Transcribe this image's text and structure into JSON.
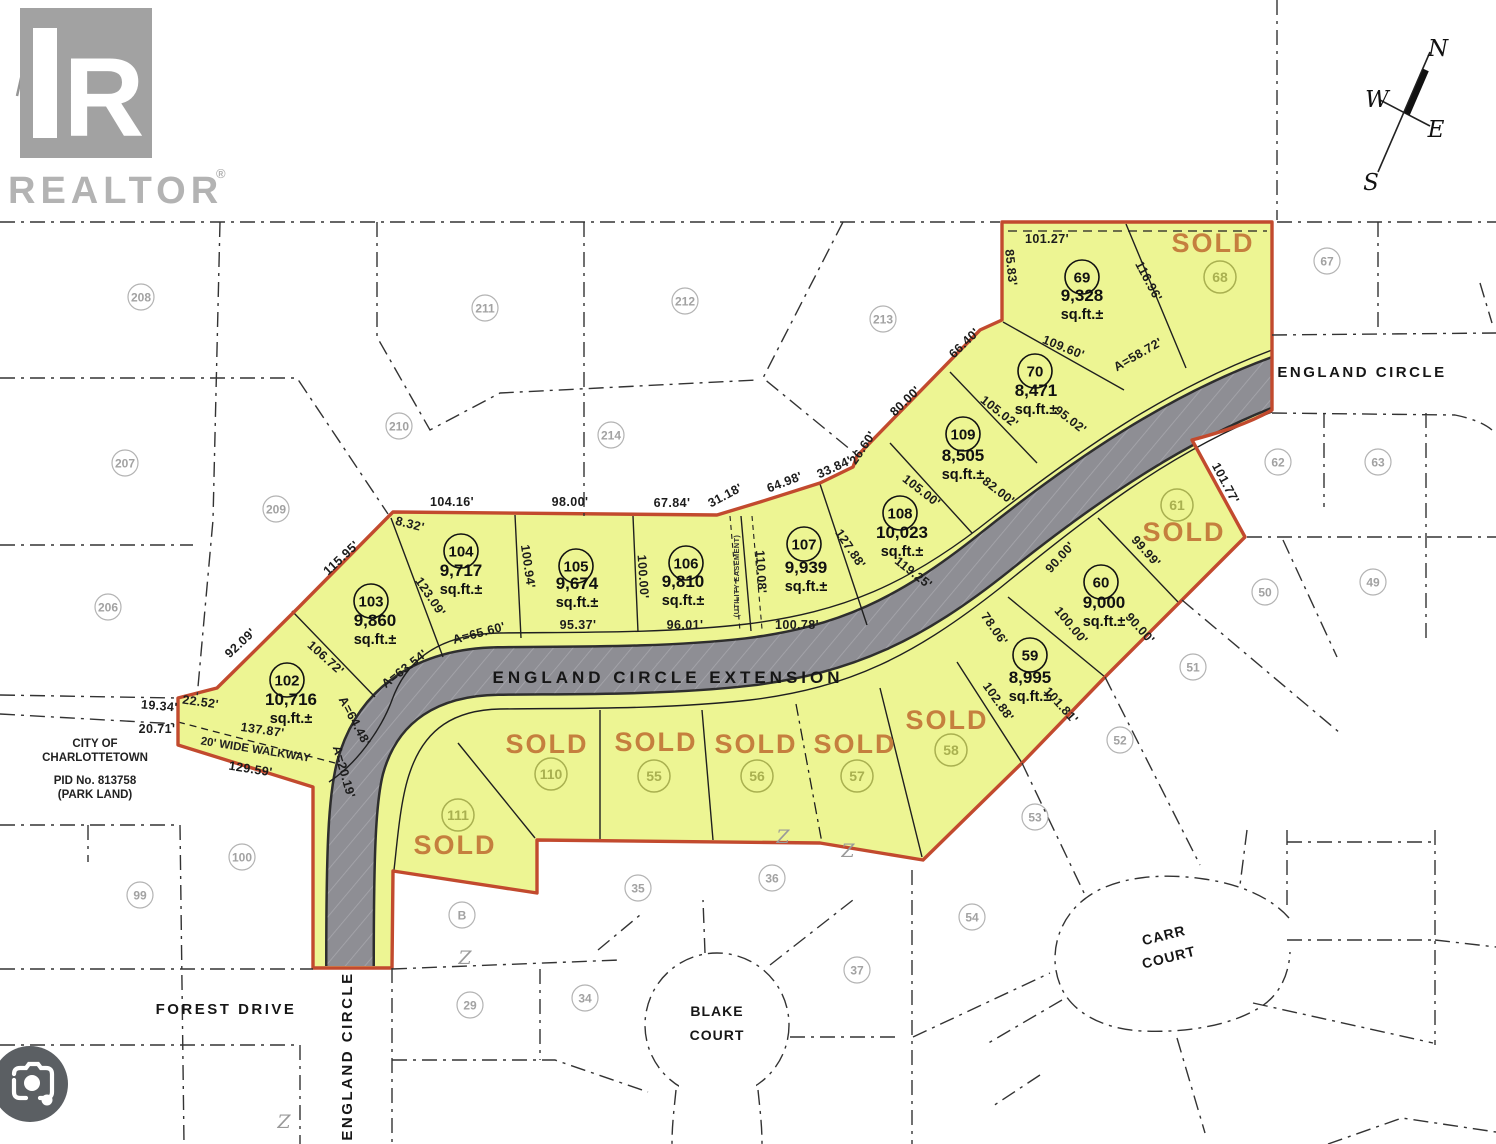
{
  "branding": {
    "logo_letter": "R",
    "logo_word": "REALTOR",
    "registered": "®"
  },
  "compass": {
    "north": "N",
    "west": "W",
    "east": "E",
    "south": "S"
  },
  "park_note": {
    "x": 95,
    "lines": [
      {
        "t": "CITY OF",
        "y": 747
      },
      {
        "t": "CHARLOTTETOWN",
        "y": 761
      },
      {
        "t": "PID No. 813758",
        "y": 784
      },
      {
        "t": "(PARK LAND)",
        "y": 798
      }
    ]
  },
  "labels": {
    "sold": "SOLD",
    "area_suffix": "sq.ft.±",
    "walkway": {
      "t": "20' WIDE WALKWAY",
      "x": 255,
      "y": 753,
      "r": 9
    },
    "easement": {
      "t": "(UTILITY EASEMENT)",
      "x": 739,
      "y": 576,
      "r": -90
    }
  },
  "roads": [
    {
      "id": "england-circle-extension",
      "label": "ENGLAND CIRCLE EXTENSION",
      "x": 668,
      "y": 683,
      "size": 17,
      "spacing": 4,
      "rot": 0
    },
    {
      "id": "england-circle-east",
      "label": "ENGLAND CIRCLE",
      "x": 1362,
      "y": 377,
      "size": 15,
      "spacing": 2.5,
      "rot": 0
    },
    {
      "id": "england-circle-south",
      "label": "ENGLAND CIRCLE",
      "x": 352,
      "y": 1056,
      "size": 15,
      "spacing": 2.5,
      "rot": -90
    },
    {
      "id": "forest-drive",
      "label": "FOREST DRIVE",
      "x": 226,
      "y": 1014,
      "size": 15,
      "spacing": 2.5,
      "rot": 0
    },
    {
      "id": "blake-court-line1",
      "label": "BLAKE",
      "x": 717,
      "y": 1016,
      "size": 14,
      "spacing": 1,
      "rot": 0
    },
    {
      "id": "blake-court-line2",
      "label": "COURT",
      "x": 717,
      "y": 1040,
      "size": 14,
      "spacing": 1,
      "rot": 0
    },
    {
      "id": "carr-court-line1",
      "label": "CARR",
      "x": 1165,
      "y": 940,
      "size": 14,
      "spacing": 1,
      "rot": -14
    },
    {
      "id": "carr-court-line2",
      "label": "COURT",
      "x": 1170,
      "y": 962,
      "size": 14,
      "spacing": 1,
      "rot": -14
    }
  ],
  "lots_available": [
    {
      "num": "102",
      "area": "10,716",
      "cx": 287,
      "cy": 680,
      "ax": 291,
      "ay": 705
    },
    {
      "num": "103",
      "area": "9,860",
      "cx": 371,
      "cy": 601,
      "ax": 375,
      "ay": 626
    },
    {
      "num": "104",
      "area": "9,717",
      "cx": 461,
      "cy": 551,
      "ax": 461,
      "ay": 576
    },
    {
      "num": "105",
      "area": "9,674",
      "cx": 576,
      "cy": 566,
      "ax": 577,
      "ay": 589
    },
    {
      "num": "106",
      "area": "9,810",
      "cx": 686,
      "cy": 563,
      "ax": 683,
      "ay": 587
    },
    {
      "num": "107",
      "area": "9,939",
      "cx": 804,
      "cy": 544,
      "ax": 806,
      "ay": 573
    },
    {
      "num": "108",
      "area": "10,023",
      "cx": 900,
      "cy": 513,
      "ax": 902,
      "ay": 538
    },
    {
      "num": "109",
      "area": "8,505",
      "cx": 963,
      "cy": 434,
      "ax": 963,
      "ay": 461
    },
    {
      "num": "70",
      "area": "8,471",
      "cx": 1035,
      "cy": 371,
      "ax": 1036,
      "ay": 396
    },
    {
      "num": "69",
      "area": "9,328",
      "cx": 1082,
      "cy": 277,
      "ax": 1082,
      "ay": 301
    },
    {
      "num": "59",
      "area": "8,995",
      "cx": 1030,
      "cy": 655,
      "ax": 1030,
      "ay": 683
    },
    {
      "num": "60",
      "area": "9,000",
      "cx": 1101,
      "cy": 582,
      "ax": 1104,
      "ay": 608
    }
  ],
  "lots_sold": [
    {
      "num": "68",
      "cx": 1220,
      "cy": 277,
      "sx": 1213,
      "sy": 252,
      "size": 29
    },
    {
      "num": "61",
      "cx": 1177,
      "cy": 505,
      "sx": 1184,
      "sy": 541,
      "size": 29
    },
    {
      "num": "58",
      "cx": 951,
      "cy": 750,
      "sx": 947,
      "sy": 729,
      "size": 27
    },
    {
      "num": "57",
      "cx": 857,
      "cy": 776,
      "sx": 855,
      "sy": 753,
      "size": 27
    },
    {
      "num": "56",
      "cx": 757,
      "cy": 776,
      "sx": 756,
      "sy": 753,
      "size": 27
    },
    {
      "num": "55",
      "cx": 654,
      "cy": 776,
      "sx": 656,
      "sy": 751,
      "size": 27
    },
    {
      "num": "110",
      "cx": 551,
      "cy": 774,
      "sx": 547,
      "sy": 753,
      "size": 27
    },
    {
      "num": "111",
      "cx": 458,
      "cy": 815,
      "sx": 455,
      "sy": 854,
      "size": 27
    }
  ],
  "lots_adjacent": [
    {
      "num": "208",
      "cx": 141,
      "cy": 297
    },
    {
      "num": "211",
      "cx": 485,
      "cy": 308
    },
    {
      "num": "212",
      "cx": 685,
      "cy": 301
    },
    {
      "num": "213",
      "cx": 883,
      "cy": 319
    },
    {
      "num": "67",
      "cx": 1327,
      "cy": 261
    },
    {
      "num": "210",
      "cx": 399,
      "cy": 426
    },
    {
      "num": "214",
      "cx": 611,
      "cy": 435
    },
    {
      "num": "207",
      "cx": 125,
      "cy": 463
    },
    {
      "num": "209",
      "cx": 276,
      "cy": 509
    },
    {
      "num": "206",
      "cx": 108,
      "cy": 607
    },
    {
      "num": "62",
      "cx": 1278,
      "cy": 462
    },
    {
      "num": "63",
      "cx": 1378,
      "cy": 462
    },
    {
      "num": "49",
      "cx": 1373,
      "cy": 582
    },
    {
      "num": "50",
      "cx": 1265,
      "cy": 592
    },
    {
      "num": "51",
      "cx": 1193,
      "cy": 667
    },
    {
      "num": "52",
      "cx": 1120,
      "cy": 740
    },
    {
      "num": "53",
      "cx": 1035,
      "cy": 817
    },
    {
      "num": "54",
      "cx": 972,
      "cy": 917
    },
    {
      "num": "100",
      "cx": 242,
      "cy": 857
    },
    {
      "num": "99",
      "cx": 140,
      "cy": 895
    },
    {
      "num": "B",
      "cx": 462,
      "cy": 915
    },
    {
      "num": "29",
      "cx": 470,
      "cy": 1005
    },
    {
      "num": "34",
      "cx": 585,
      "cy": 998
    },
    {
      "num": "35",
      "cx": 638,
      "cy": 888
    },
    {
      "num": "36",
      "cx": 772,
      "cy": 878
    },
    {
      "num": "37",
      "cx": 857,
      "cy": 970
    }
  ],
  "dimensions": [
    {
      "t": "101.27'",
      "x": 1047,
      "y": 243,
      "r": 0
    },
    {
      "t": "85.83'",
      "x": 1007,
      "y": 268,
      "r": 84
    },
    {
      "t": "116.96'",
      "x": 1145,
      "y": 283,
      "r": 62
    },
    {
      "t": "109.60'",
      "x": 1062,
      "y": 351,
      "r": 22
    },
    {
      "t": "A=58.72'",
      "x": 1140,
      "y": 358,
      "r": -30
    },
    {
      "t": "66.40'",
      "x": 967,
      "y": 346,
      "r": -44
    },
    {
      "t": "80.00'",
      "x": 908,
      "y": 404,
      "r": -44
    },
    {
      "t": "105.02'",
      "x": 997,
      "y": 415,
      "r": 38
    },
    {
      "t": "95.02'",
      "x": 1068,
      "y": 423,
      "r": 38
    },
    {
      "t": "105.00'",
      "x": 919,
      "y": 494,
      "r": 38
    },
    {
      "t": "82.00'",
      "x": 996,
      "y": 494,
      "r": 38
    },
    {
      "t": "119.25'",
      "x": 911,
      "y": 576,
      "r": 38
    },
    {
      "t": "26.60'",
      "x": 866,
      "y": 450,
      "r": -56
    },
    {
      "t": "33.84'",
      "x": 836,
      "y": 471,
      "r": -24
    },
    {
      "t": "64.98'",
      "x": 786,
      "y": 486,
      "r": -21
    },
    {
      "t": "31.18'",
      "x": 727,
      "y": 499,
      "r": -28
    },
    {
      "t": "67.84'",
      "x": 672,
      "y": 507,
      "r": 0
    },
    {
      "t": "98.00'",
      "x": 570,
      "y": 506,
      "r": 0
    },
    {
      "t": "104.16'",
      "x": 452,
      "y": 506,
      "r": 0
    },
    {
      "t": "8.32'",
      "x": 409,
      "y": 528,
      "r": 14
    },
    {
      "t": "115.95'",
      "x": 344,
      "y": 561,
      "r": -43
    },
    {
      "t": "92.09'",
      "x": 243,
      "y": 646,
      "r": -43
    },
    {
      "t": "123.09'",
      "x": 427,
      "y": 599,
      "r": 56
    },
    {
      "t": "100.94'",
      "x": 524,
      "y": 567,
      "r": 82
    },
    {
      "t": "100.00'",
      "x": 639,
      "y": 577,
      "r": 86
    },
    {
      "t": "110.08'",
      "x": 757,
      "y": 572,
      "r": 87
    },
    {
      "t": "127.88'",
      "x": 847,
      "y": 551,
      "r": 56
    },
    {
      "t": "95.37'",
      "x": 578,
      "y": 629,
      "r": 0
    },
    {
      "t": "96.01'",
      "x": 685,
      "y": 629,
      "r": 0
    },
    {
      "t": "100.78'",
      "x": 797,
      "y": 629,
      "r": 0
    },
    {
      "t": "A=65.60'",
      "x": 480,
      "y": 637,
      "r": -15
    },
    {
      "t": "A=63.54'",
      "x": 407,
      "y": 672,
      "r": -38
    },
    {
      "t": "106.72'",
      "x": 323,
      "y": 661,
      "r": 42
    },
    {
      "t": "A=64.48'",
      "x": 351,
      "y": 723,
      "r": 62
    },
    {
      "t": "A=20.19'",
      "x": 340,
      "y": 773,
      "r": 74
    },
    {
      "t": "22.52'",
      "x": 200,
      "y": 706,
      "r": 8
    },
    {
      "t": "19.34'",
      "x": 159,
      "y": 710,
      "r": 5
    },
    {
      "t": "20.71'",
      "x": 157,
      "y": 733,
      "r": 0
    },
    {
      "t": "137.87'",
      "x": 262,
      "y": 734,
      "r": 8
    },
    {
      "t": "129.59'",
      "x": 250,
      "y": 773,
      "r": 9
    },
    {
      "t": "78.06'",
      "x": 991,
      "y": 631,
      "r": 55
    },
    {
      "t": "102.88'",
      "x": 995,
      "y": 704,
      "r": 55
    },
    {
      "t": "100.00'",
      "x": 1068,
      "y": 628,
      "r": 50
    },
    {
      "t": "101.81'",
      "x": 1058,
      "y": 708,
      "r": 48
    },
    {
      "t": "90.00'",
      "x": 1063,
      "y": 560,
      "r": -48
    },
    {
      "t": "99.99'",
      "x": 1143,
      "y": 554,
      "r": 48
    },
    {
      "t": "90.00'",
      "x": 1137,
      "y": 631,
      "r": 48
    },
    {
      "t": "101.77'",
      "x": 1222,
      "y": 485,
      "r": 62
    }
  ],
  "z_marks": [
    {
      "x": 783,
      "y": 843
    },
    {
      "x": 848,
      "y": 857
    },
    {
      "x": 465,
      "y": 964
    },
    {
      "x": 284,
      "y": 1128
    }
  ],
  "colors": {
    "parcel_fill": "#edf593",
    "boundary": "#c24a2e",
    "road": "#8e8e94",
    "sold_text": "#c57f3e",
    "sold_circle": "#a9b050",
    "adjacent": "#b3b3b3"
  }
}
